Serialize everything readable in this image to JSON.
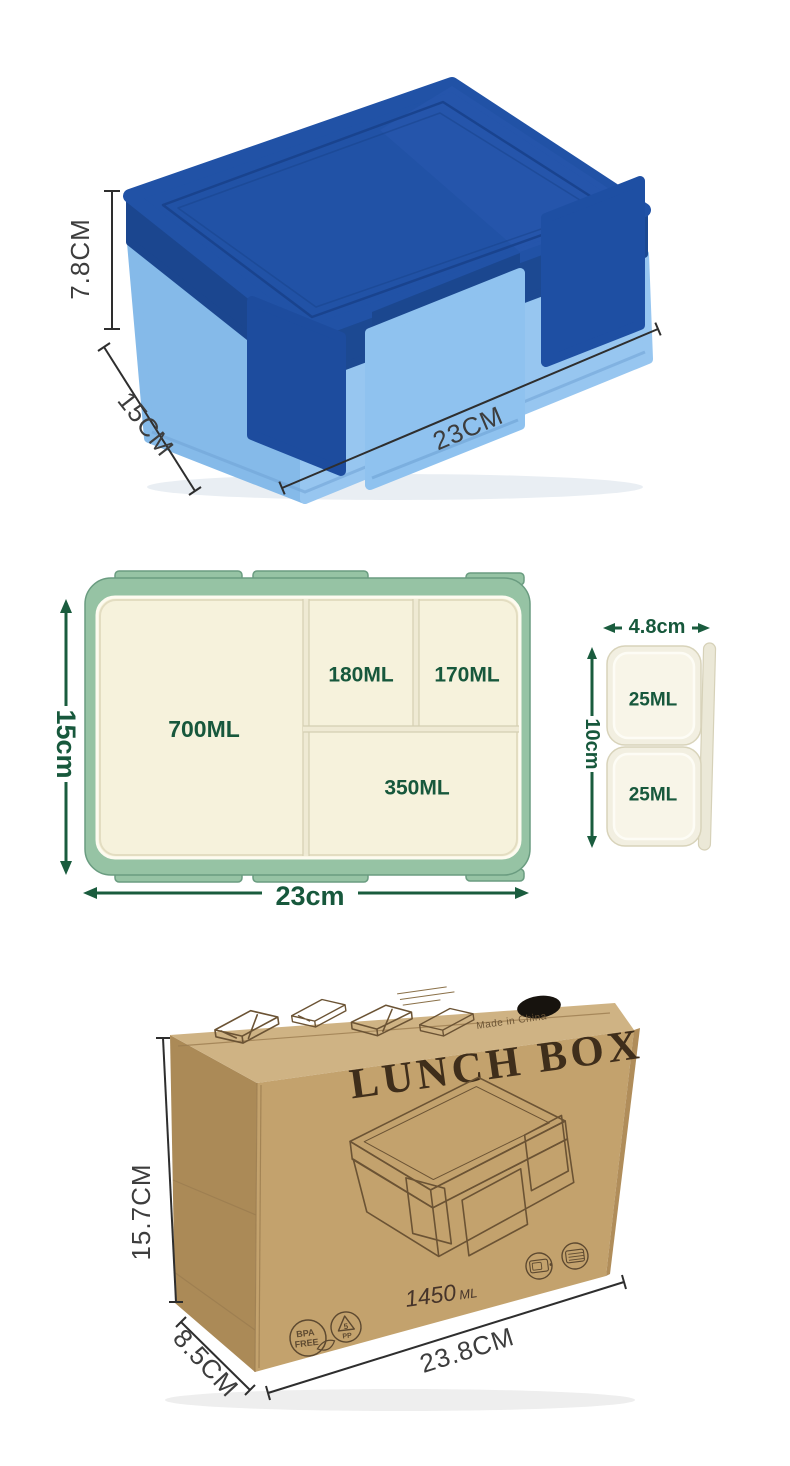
{
  "product": {
    "box_photo": {
      "height_label": "7.8CM",
      "depth_label": "15CM",
      "width_label": "23CM"
    },
    "tray": {
      "main_compartment": "700ML",
      "compartment_2": "180ML",
      "compartment_3": "170ML",
      "compartment_4": "350ML",
      "height_label": "15cm",
      "width_label": "23cm"
    },
    "sauce_box": {
      "cell_1": "25ML",
      "cell_2": "25ML",
      "width_label": "4.8cm",
      "height_label": "10cm"
    },
    "package": {
      "title": "LUNCH BOX",
      "capacity_value": "1450",
      "capacity_unit": "ML",
      "origin": "Made in China",
      "badge_bpa_line1": "BPA",
      "badge_bpa_line2": "FREE",
      "badge_pp_number": "5",
      "badge_pp_label": "PP",
      "height_label": "15.7CM",
      "depth_label": "8.5CM",
      "width_label": "23.8CM"
    },
    "colors": {
      "lid_blue": "#2152a6",
      "body_blue": "#8cc0ee",
      "tray_green_rim": "#96c3a4",
      "tray_cream": "#f6f2dc",
      "dimension_green": "#1a5c3e",
      "kraft_brown": "#c3a26d"
    }
  }
}
